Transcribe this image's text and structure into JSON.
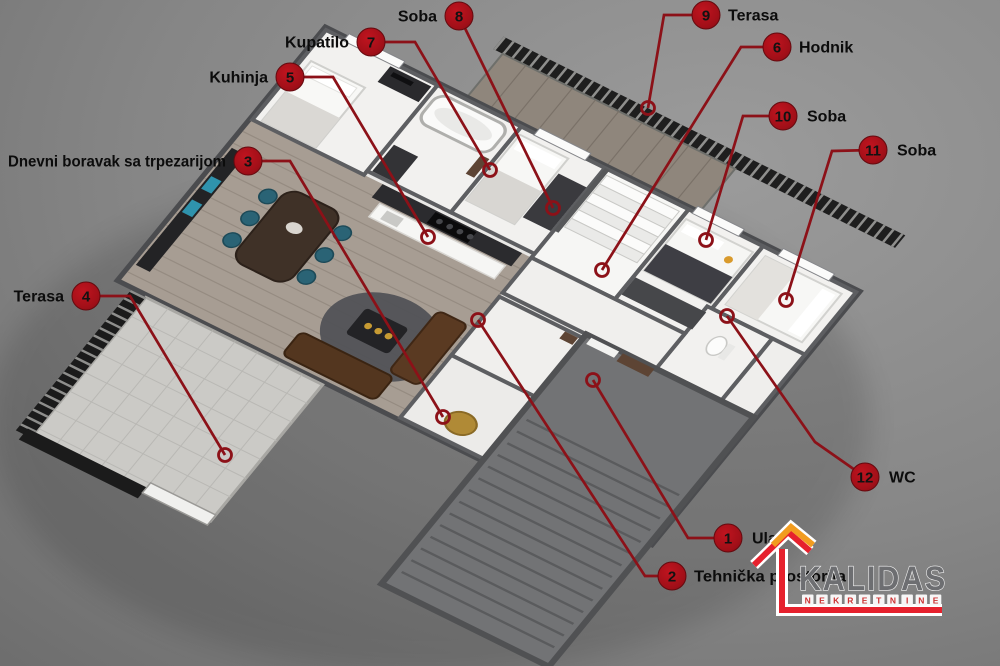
{
  "image": {
    "type": "3d-floor-plan-render",
    "width": 1000,
    "height": 666
  },
  "colors": {
    "background_inner": "#9b9b9b",
    "background_outer": "#6d6d6d",
    "leader_line": "#8c1118",
    "callout_fill_center": "#c0141f",
    "callout_fill_edge": "#8a0d14",
    "callout_stroke": "#640a0f",
    "callout_number": "#121212",
    "label_text": "#0c0c0c",
    "wall": "#4b4c4f",
    "room_floor": "#f2f1ef",
    "wood_floor": "#a79d93",
    "terrace_floor": "#cbcac6",
    "stair_block": "#727375",
    "railing": "#1e1e1e"
  },
  "annotations": [
    {
      "id": "ulaz",
      "number": "1",
      "label": "Ulaz",
      "side": "right",
      "circle": {
        "x": 728,
        "y": 538
      },
      "label_pos": {
        "x": 752,
        "y": 538
      },
      "leader": [
        [
          728,
          538
        ],
        [
          688,
          538
        ],
        [
          593,
          380
        ]
      ]
    },
    {
      "id": "tehnicka-prostorija",
      "number": "2",
      "label": "Tehnička prostorija",
      "side": "right",
      "circle": {
        "x": 672,
        "y": 576
      },
      "label_pos": {
        "x": 694,
        "y": 576
      },
      "max_len": 152,
      "leader": [
        [
          672,
          576
        ],
        [
          645,
          576
        ],
        [
          478,
          320
        ]
      ]
    },
    {
      "id": "dnevni-boravak",
      "number": "3",
      "label": "Dnevni boravak sa trpezarijom",
      "side": "left",
      "circle": {
        "x": 248,
        "y": 161
      },
      "label_pos": {
        "x": 226,
        "y": 161
      },
      "max_len": 218,
      "leader": [
        [
          248,
          161
        ],
        [
          290,
          161
        ],
        [
          443,
          417
        ]
      ]
    },
    {
      "id": "terasa-4",
      "number": "4",
      "label": "Terasa",
      "side": "left",
      "circle": {
        "x": 86,
        "y": 296
      },
      "label_pos": {
        "x": 64,
        "y": 296
      },
      "leader": [
        [
          86,
          296
        ],
        [
          130,
          296
        ],
        [
          225,
          455
        ]
      ]
    },
    {
      "id": "kuhinja",
      "number": "5",
      "label": "Kuhinja",
      "side": "left",
      "circle": {
        "x": 290,
        "y": 77
      },
      "label_pos": {
        "x": 268,
        "y": 77
      },
      "leader": [
        [
          290,
          77
        ],
        [
          333,
          77
        ],
        [
          428,
          237
        ]
      ]
    },
    {
      "id": "hodnik",
      "number": "6",
      "label": "Hodnik",
      "side": "right",
      "circle": {
        "x": 777,
        "y": 47
      },
      "label_pos": {
        "x": 799,
        "y": 47
      },
      "leader": [
        [
          777,
          47
        ],
        [
          741,
          47
        ],
        [
          602,
          270
        ]
      ]
    },
    {
      "id": "kupatilo",
      "number": "7",
      "label": "Kupatilo",
      "side": "left",
      "circle": {
        "x": 371,
        "y": 42
      },
      "label_pos": {
        "x": 349,
        "y": 42
      },
      "leader": [
        [
          371,
          42
        ],
        [
          415,
          42
        ],
        [
          490,
          170
        ]
      ]
    },
    {
      "id": "soba-8",
      "number": "8",
      "label": "Soba",
      "side": "left",
      "circle": {
        "x": 459,
        "y": 16
      },
      "label_pos": {
        "x": 437,
        "y": 16
      },
      "leader": [
        [
          459,
          16
        ],
        [
          553,
          208
        ]
      ]
    },
    {
      "id": "terasa-9",
      "number": "9",
      "label": "Terasa",
      "side": "right",
      "circle": {
        "x": 706,
        "y": 15
      },
      "label_pos": {
        "x": 728,
        "y": 15
      },
      "leader": [
        [
          706,
          15
        ],
        [
          664,
          15
        ],
        [
          648,
          108
        ]
      ]
    },
    {
      "id": "soba-10",
      "number": "10",
      "label": "Soba",
      "side": "right",
      "circle": {
        "x": 783,
        "y": 116
      },
      "label_pos": {
        "x": 807,
        "y": 116
      },
      "leader": [
        [
          783,
          116
        ],
        [
          743,
          116
        ],
        [
          706,
          240
        ]
      ]
    },
    {
      "id": "soba-11",
      "number": "11",
      "label": "Soba",
      "side": "right",
      "circle": {
        "x": 873,
        "y": 150
      },
      "label_pos": {
        "x": 897,
        "y": 150
      },
      "leader": [
        [
          873,
          150
        ],
        [
          832,
          151
        ],
        [
          786,
          300
        ]
      ]
    },
    {
      "id": "wc",
      "number": "12",
      "label": "WC",
      "side": "right",
      "circle": {
        "x": 865,
        "y": 477
      },
      "label_pos": {
        "x": 889,
        "y": 477
      },
      "leader": [
        [
          865,
          477
        ],
        [
          815,
          442
        ],
        [
          727,
          316
        ]
      ]
    }
  ],
  "logo": {
    "title": "KALIDAS",
    "subtitle": "NEKRETNINE",
    "title_color": "#6d6e71",
    "title_outline": "#f2f2f2",
    "subtitle_color": "#cc3333",
    "subtitle_box": "#f6f6f6",
    "roof_red": "#e6212d",
    "roof_orange": "#f29c1f",
    "line_red": "#e6212d",
    "casing": "#ffffff"
  }
}
